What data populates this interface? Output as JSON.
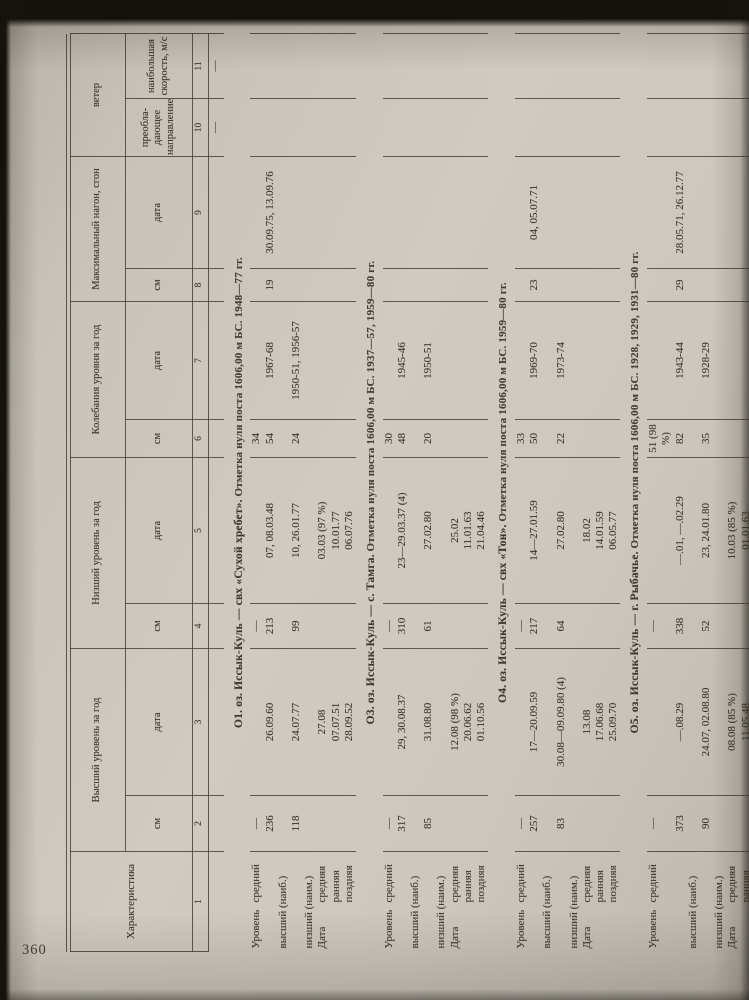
{
  "page_number": "360",
  "table": {
    "header": {
      "characteristic": "Характеристика",
      "groups": [
        {
          "label": "Высший уровень за год",
          "subs": [
            "см",
            "дата"
          ]
        },
        {
          "label": "Низший уровень за год",
          "subs": [
            "см",
            "дата"
          ]
        },
        {
          "label": "Колебания уровня за год",
          "subs": [
            "см",
            "дата"
          ]
        },
        {
          "label": "Максимальный нагон, сгон",
          "subs": [
            "см",
            "дата"
          ]
        },
        {
          "label": "ветер",
          "subs": [
            "преобла-дающее направление",
            "наибольшая скорость, м/с"
          ]
        }
      ]
    },
    "column_numbers": [
      "1",
      "2",
      "3",
      "4",
      "5",
      "6",
      "7",
      "8",
      "9",
      "10",
      "11"
    ],
    "pre_row": {
      "c10": "—",
      "c11": "—"
    },
    "row_label_note": "Уровень/Дата characteristic rows",
    "sections": [
      {
        "name": "О1. оз. Иссык-Куль — свх «Сухой хребет».",
        "note": "Отметка нуля поста 1606,00 м БС. 1948—77 гг.",
        "rows": [
          {
            "label_main": "Уровень",
            "label_sub": "средний",
            "cells": [
              "—",
              "",
              "—",
              "",
              "34",
              "",
              "",
              "",
              "",
              ""
            ]
          },
          {
            "label_main": "",
            "label_sub": "высший (наиб.)",
            "cells": [
              "236",
              "26.09.60",
              "213",
              "07, 08.03.48",
              "54",
              "1967-68",
              "19",
              "30.09.75, 13.09.76",
              "",
              ""
            ]
          },
          {
            "label_main": "",
            "label_sub": "низший (наим.)",
            "cells": [
              "118",
              "24.07.77",
              "99",
              "10, 26.01.77",
              "24",
              "1950-51, 1956-57",
              "",
              "",
              "",
              ""
            ]
          },
          {
            "label_main": "Дата",
            "label_sub": "средняя",
            "cells": [
              "",
              "27.08",
              "",
              "03.03 (97 %)",
              "",
              "",
              "",
              "",
              "",
              ""
            ]
          },
          {
            "label_main": "",
            "label_sub": "ранняя",
            "cells": [
              "",
              "07.07.51",
              "",
              "10.01.77",
              "",
              "",
              "",
              "",
              "",
              ""
            ]
          },
          {
            "label_main": "",
            "label_sub": "поздняя",
            "cells": [
              "",
              "28.09.52",
              "",
              "06.07.76",
              "",
              "",
              "",
              "",
              "",
              ""
            ]
          }
        ]
      },
      {
        "name": "О3. оз. Иссык-Куль — с. Тамга.",
        "note": "Отметка нуля поста 1606,00 м БС. 1937—57, 1959—80 гг.",
        "rows": [
          {
            "label_main": "Уровень",
            "label_sub": "средний",
            "cells": [
              "—",
              "",
              "—",
              "",
              "30",
              "",
              "",
              "",
              "",
              ""
            ]
          },
          {
            "label_main": "",
            "label_sub": "высший (наиб.)",
            "cells": [
              "317",
              "29, 30.08.37",
              "310",
              "23—29.03.37 (4)",
              "48",
              "1945-46",
              "",
              "",
              "",
              ""
            ]
          },
          {
            "label_main": "",
            "label_sub": "низший (наим.)",
            "cells": [
              "85",
              "31.08.80",
              "61",
              "27.02.80",
              "20",
              "1950-51",
              "",
              "",
              "",
              ""
            ]
          },
          {
            "label_main": "Дата",
            "label_sub": "средняя",
            "cells": [
              "",
              "12.08 (98 %)",
              "",
              "25.02",
              "",
              "",
              "",
              "",
              "",
              ""
            ]
          },
          {
            "label_main": "",
            "label_sub": "ранняя",
            "cells": [
              "",
              "20.06.62",
              "",
              "11.01.63",
              "",
              "",
              "",
              "",
              "",
              ""
            ]
          },
          {
            "label_main": "",
            "label_sub": "поздняя",
            "cells": [
              "",
              "01.10.56",
              "",
              "21.04.46",
              "",
              "",
              "",
              "",
              "",
              ""
            ]
          }
        ]
      },
      {
        "name": "О4. оз. Иссык-Куль — свх «Тон».",
        "note": "Отметка нуля поста 1606,00 м БС. 1959—80 гг.",
        "rows": [
          {
            "label_main": "Уровень",
            "label_sub": "средний",
            "cells": [
              "—",
              "",
              "—",
              "",
              "33",
              "",
              "",
              "",
              "",
              ""
            ]
          },
          {
            "label_main": "",
            "label_sub": "высший (наиб.)",
            "cells": [
              "257",
              "17—20.09.59",
              "217",
              "14—27.01.59",
              "50",
              "1969-70",
              "23",
              "04, 05.07.71",
              "",
              ""
            ]
          },
          {
            "label_main": "",
            "label_sub": "низший (наим.)",
            "cells": [
              "83",
              "30.08—09.09.80 (4)",
              "64",
              "27.02.80",
              "22",
              "1973-74",
              "",
              "",
              "",
              ""
            ]
          },
          {
            "label_main": "Дата",
            "label_sub": "средняя",
            "cells": [
              "",
              "13.08",
              "",
              "18.02",
              "",
              "",
              "",
              "",
              "",
              ""
            ]
          },
          {
            "label_main": "",
            "label_sub": "ранняя",
            "cells": [
              "",
              "17.06.68",
              "",
              "14.01.59",
              "",
              "",
              "",
              "",
              "",
              ""
            ]
          },
          {
            "label_main": "",
            "label_sub": "поздняя",
            "cells": [
              "",
              "25.09.70",
              "",
              "06.05.77",
              "",
              "",
              "",
              "",
              "",
              ""
            ]
          }
        ]
      },
      {
        "name": "О5. оз. Иссык-Куль — г. Рыбачье.",
        "note": "Отметка нуля поста 1606,00 м БС. 1928, 1929, 1931—80 гг.",
        "rows": [
          {
            "label_main": "Уровень",
            "label_sub": "средний",
            "cells": [
              "—",
              "",
              "—",
              "",
              "51 (98 %)",
              "",
              "",
              "",
              "",
              ""
            ]
          },
          {
            "label_main": "",
            "label_sub": "высший (наиб.)",
            "cells": [
              "373",
              "—.08.29",
              "338",
              "—.01, —.02.29",
              "82",
              "1943-44",
              "29",
              "28.05.71, 26.12.77",
              "",
              ""
            ]
          },
          {
            "label_main": "",
            "label_sub": "низший (наим.)",
            "cells": [
              "90",
              "24.07, 02.08.80",
              "52",
              "23, 24.01.80",
              "35",
              "1928-29",
              "",
              "",
              "",
              ""
            ]
          },
          {
            "label_main": "Дата",
            "label_sub": "средняя",
            "cells": [
              "",
              "08.08 (85 %)",
              "",
              "10.03 (85 %)",
              "",
              "",
              "",
              "",
              "",
              ""
            ]
          },
          {
            "label_main": "",
            "label_sub": "ранняя",
            "cells": [
              "",
              "11.05.48",
              "",
              "01.01.63",
              "",
              "",
              "",
              "",
              "",
              ""
            ]
          },
          {
            "label_main": "",
            "label_sub": "поздняя",
            "cells": [
              "",
              "04.10.71",
              "",
              "13.05.48",
              "",
              "",
              "",
              "",
              "",
              ""
            ]
          }
        ]
      }
    ]
  }
}
